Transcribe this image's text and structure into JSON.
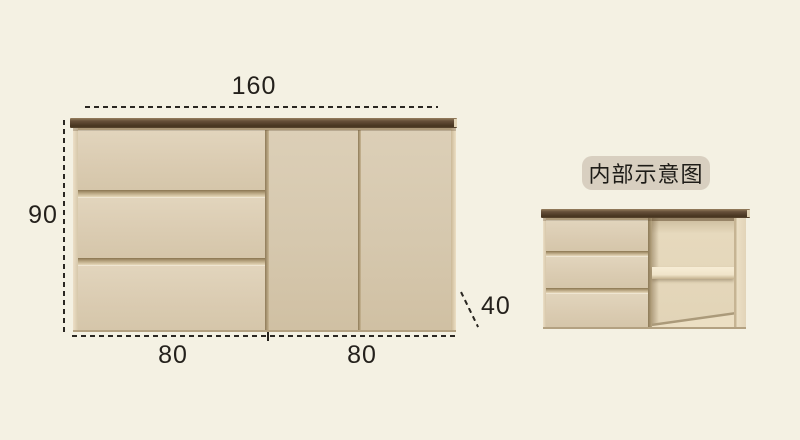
{
  "diagram": {
    "dimensions": {
      "width": "160",
      "height": "90",
      "depth": "40",
      "bottom_left": "80",
      "bottom_right": "80"
    },
    "inset_label": "内部示意图",
    "colors": {
      "background": "#f4f1e3",
      "cabinet_body": "#d9cbb2",
      "cabinet_top_slab": "#55422e",
      "dimension_ink": "#24211c",
      "badge_background": "#d8cfc0",
      "badge_text": "#1e1c18"
    }
  }
}
